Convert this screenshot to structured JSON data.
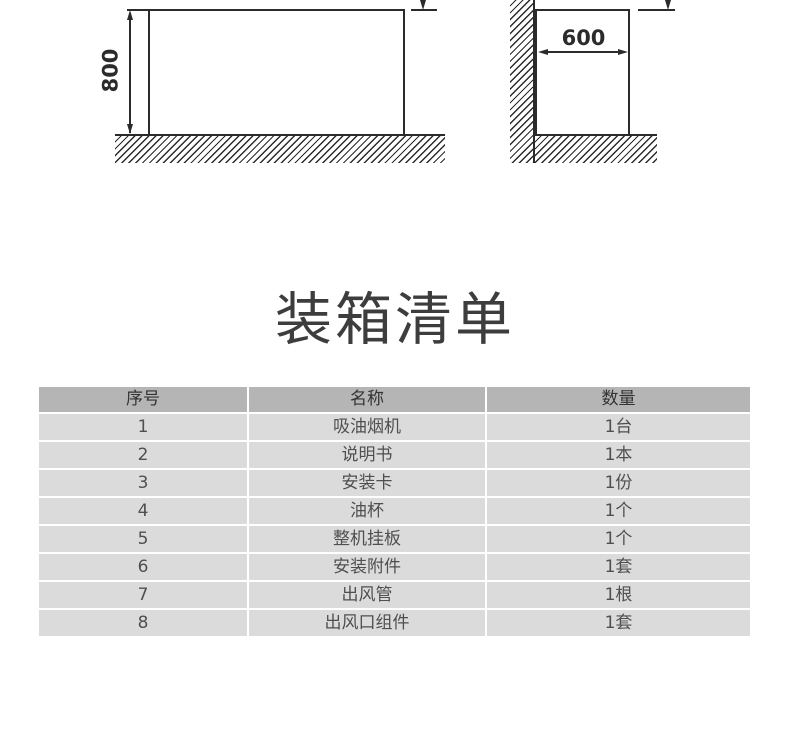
{
  "diagrams": {
    "front_view": {
      "height_dimension": "800"
    },
    "side_view": {
      "width_dimension": "600"
    }
  },
  "packing_list": {
    "title": "装箱清单",
    "columns": [
      "序号",
      "名称",
      "数量"
    ],
    "rows": [
      [
        "1",
        "吸油烟机",
        "1台"
      ],
      [
        "2",
        "说明书",
        "1本"
      ],
      [
        "3",
        "安装卡",
        "1份"
      ],
      [
        "4",
        "油杯",
        "1个"
      ],
      [
        "5",
        "整机挂板",
        "1个"
      ],
      [
        "6",
        "安装附件",
        "1套"
      ],
      [
        "7",
        "出风管",
        "1根"
      ],
      [
        "8",
        "出风口组件",
        "1套"
      ]
    ]
  },
  "colors": {
    "drawing_line": "#2b2b2b",
    "table_header_bg": "#b5b5b5",
    "table_row_bg": "#dbdbdb",
    "header_text": "#333333",
    "row_text": "#4f4f4f",
    "title_text": "#3d3d3d",
    "page_bg": "#ffffff"
  }
}
